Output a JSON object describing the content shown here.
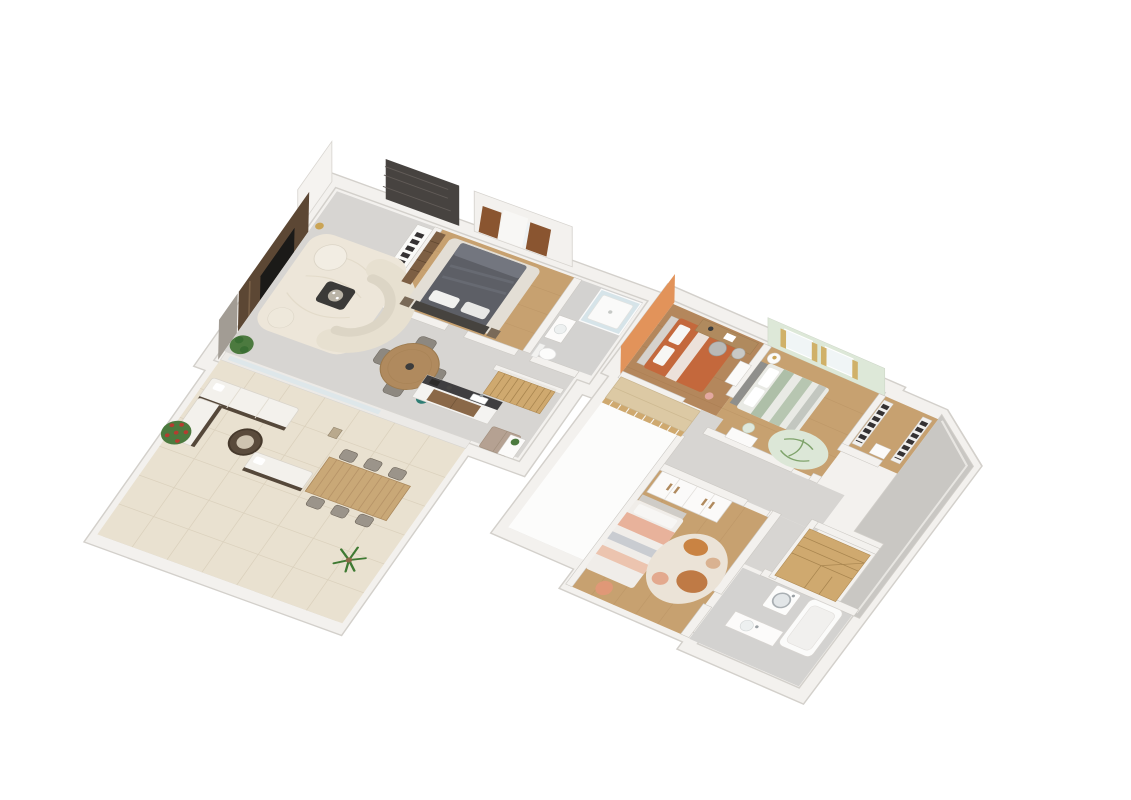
{
  "document": {
    "title": "3D axonometric floor plans of a two-storey house",
    "background": "#ffffff",
    "plan_count": 2
  },
  "palette": {
    "bg": "#ffffff",
    "wallFill": "#f3f1ee",
    "wallEdge": "#cbc8c3",
    "wallOuter": "#d3d0cb",
    "floorGray": "#d7d5d2",
    "floorWood": "#c7a170",
    "floorWoodDark": "#b4875c",
    "bathFloor": "#d3d2d0",
    "floorTile": "#e9e1d0",
    "tileLine": "#dbd1bd",
    "roofGray": "#c9c7c3",
    "stoneDark": "#474340",
    "tvWallBrown": "#5c4734",
    "rugCream": "#ede6d9",
    "sofaCream": "#e7e0d0",
    "counterDark": "#3f3e40",
    "woodCabinet": "#8a6848",
    "woodMid": "#b08a5e",
    "taupe": "#b5a192",
    "stairWood": "#cfa96f",
    "bedGray": "#5d5f66",
    "glassBlue": "#d7e6ec",
    "teal": "#2e7d74",
    "plantGreen": "#4c7a3f",
    "flowerRed": "#b43c30",
    "orangeWall": "#e2935a",
    "terracotta": "#c4683c",
    "mintWall": "#dde8d8",
    "sageBed": "#aebfa8",
    "curtainYellow": "#d0b169",
    "curtainBrown": "#8a5530",
    "tanCabinet": "#dcc9a4",
    "clothesDark": "#353233"
  },
  "plans": [
    {
      "id": "ground-floor",
      "label": "Ground floor",
      "rooms": [
        {
          "name": "living-room",
          "floor": "gray concrete",
          "furniture": [
            "stone-accent-wall",
            "tv-media-wall",
            "curved-sofa",
            "armchair",
            "pouf",
            "coffee-table",
            "area-rug",
            "floor-plant",
            "floor-lamp",
            "open-wardrobe"
          ]
        },
        {
          "name": "dining-area",
          "floor": "gray concrete",
          "furniture": [
            "round-wood-table",
            "four-chairs",
            "teal-plant-pot"
          ]
        },
        {
          "name": "kitchen",
          "floor": "gray concrete",
          "furniture": [
            "counter-dark-top",
            "sink",
            "walnut-cabinet",
            "taupe-fridge-cabinet",
            "shelf-unit",
            "wood-staircase"
          ]
        },
        {
          "name": "master-bedroom",
          "floor": "oak wood",
          "furniture": [
            "double-bed-gray",
            "dark-headboard",
            "two-pillows",
            "two-nightstands",
            "slatted-wardrobe",
            "window-bay-curtains"
          ]
        },
        {
          "name": "bathroom",
          "floor": "gray tile",
          "furniture": [
            "glass-shower",
            "vanity-sink",
            "toilet"
          ]
        },
        {
          "name": "terrace",
          "floor": "beige tile",
          "furniture": [
            "outdoor-corner-sofa",
            "outdoor-bench",
            "wicker-coffee-table",
            "slatted-dining-table",
            "six-outdoor-chairs",
            "red-flowering-shrub",
            "palm-plant",
            "lantern"
          ]
        }
      ]
    },
    {
      "id": "upper-floor",
      "label": "Upper floor",
      "rooms": [
        {
          "name": "bedroom-orange",
          "floor": "walnut wood",
          "furniture": [
            "terracotta-bed",
            "white-headboard",
            "wood-desk",
            "two-desk-chairs",
            "shelf-unit",
            "orange-accent-wall"
          ]
        },
        {
          "name": "bedroom-mint",
          "floor": "oak wood",
          "furniture": [
            "sage-striped-bed",
            "round-nightstand-lamp",
            "palm-print-rug",
            "small-white-desk",
            "two-windows-yellow-curtains",
            "mint-accent-wall"
          ]
        },
        {
          "name": "walk-in-closet",
          "floor": "oak wood",
          "furniture": [
            "clothes-rack-left",
            "clothes-rack-right",
            "shelf"
          ]
        },
        {
          "name": "bedroom-peach",
          "floor": "oak wood",
          "furniture": [
            "striped-peach-bed",
            "white-wardrobe-wood-handles",
            "blob-pattern-rug",
            "salmon-pouf"
          ]
        },
        {
          "name": "landing-hallway",
          "floor": "gray concrete",
          "furniture": [
            "tan-low-cabinet",
            "wood-slat-railing",
            "void-over-ground-floor"
          ]
        },
        {
          "name": "bathroom-upper",
          "floor": "gray tile",
          "furniture": [
            "washing-machine",
            "bathtub",
            "vanity-sink"
          ]
        },
        {
          "name": "staircase-upper",
          "floor": "wood",
          "furniture": [
            "winding-wood-steps"
          ]
        },
        {
          "name": "flat-roof-section",
          "floor": "gray roof",
          "furniture": []
        }
      ]
    }
  ]
}
